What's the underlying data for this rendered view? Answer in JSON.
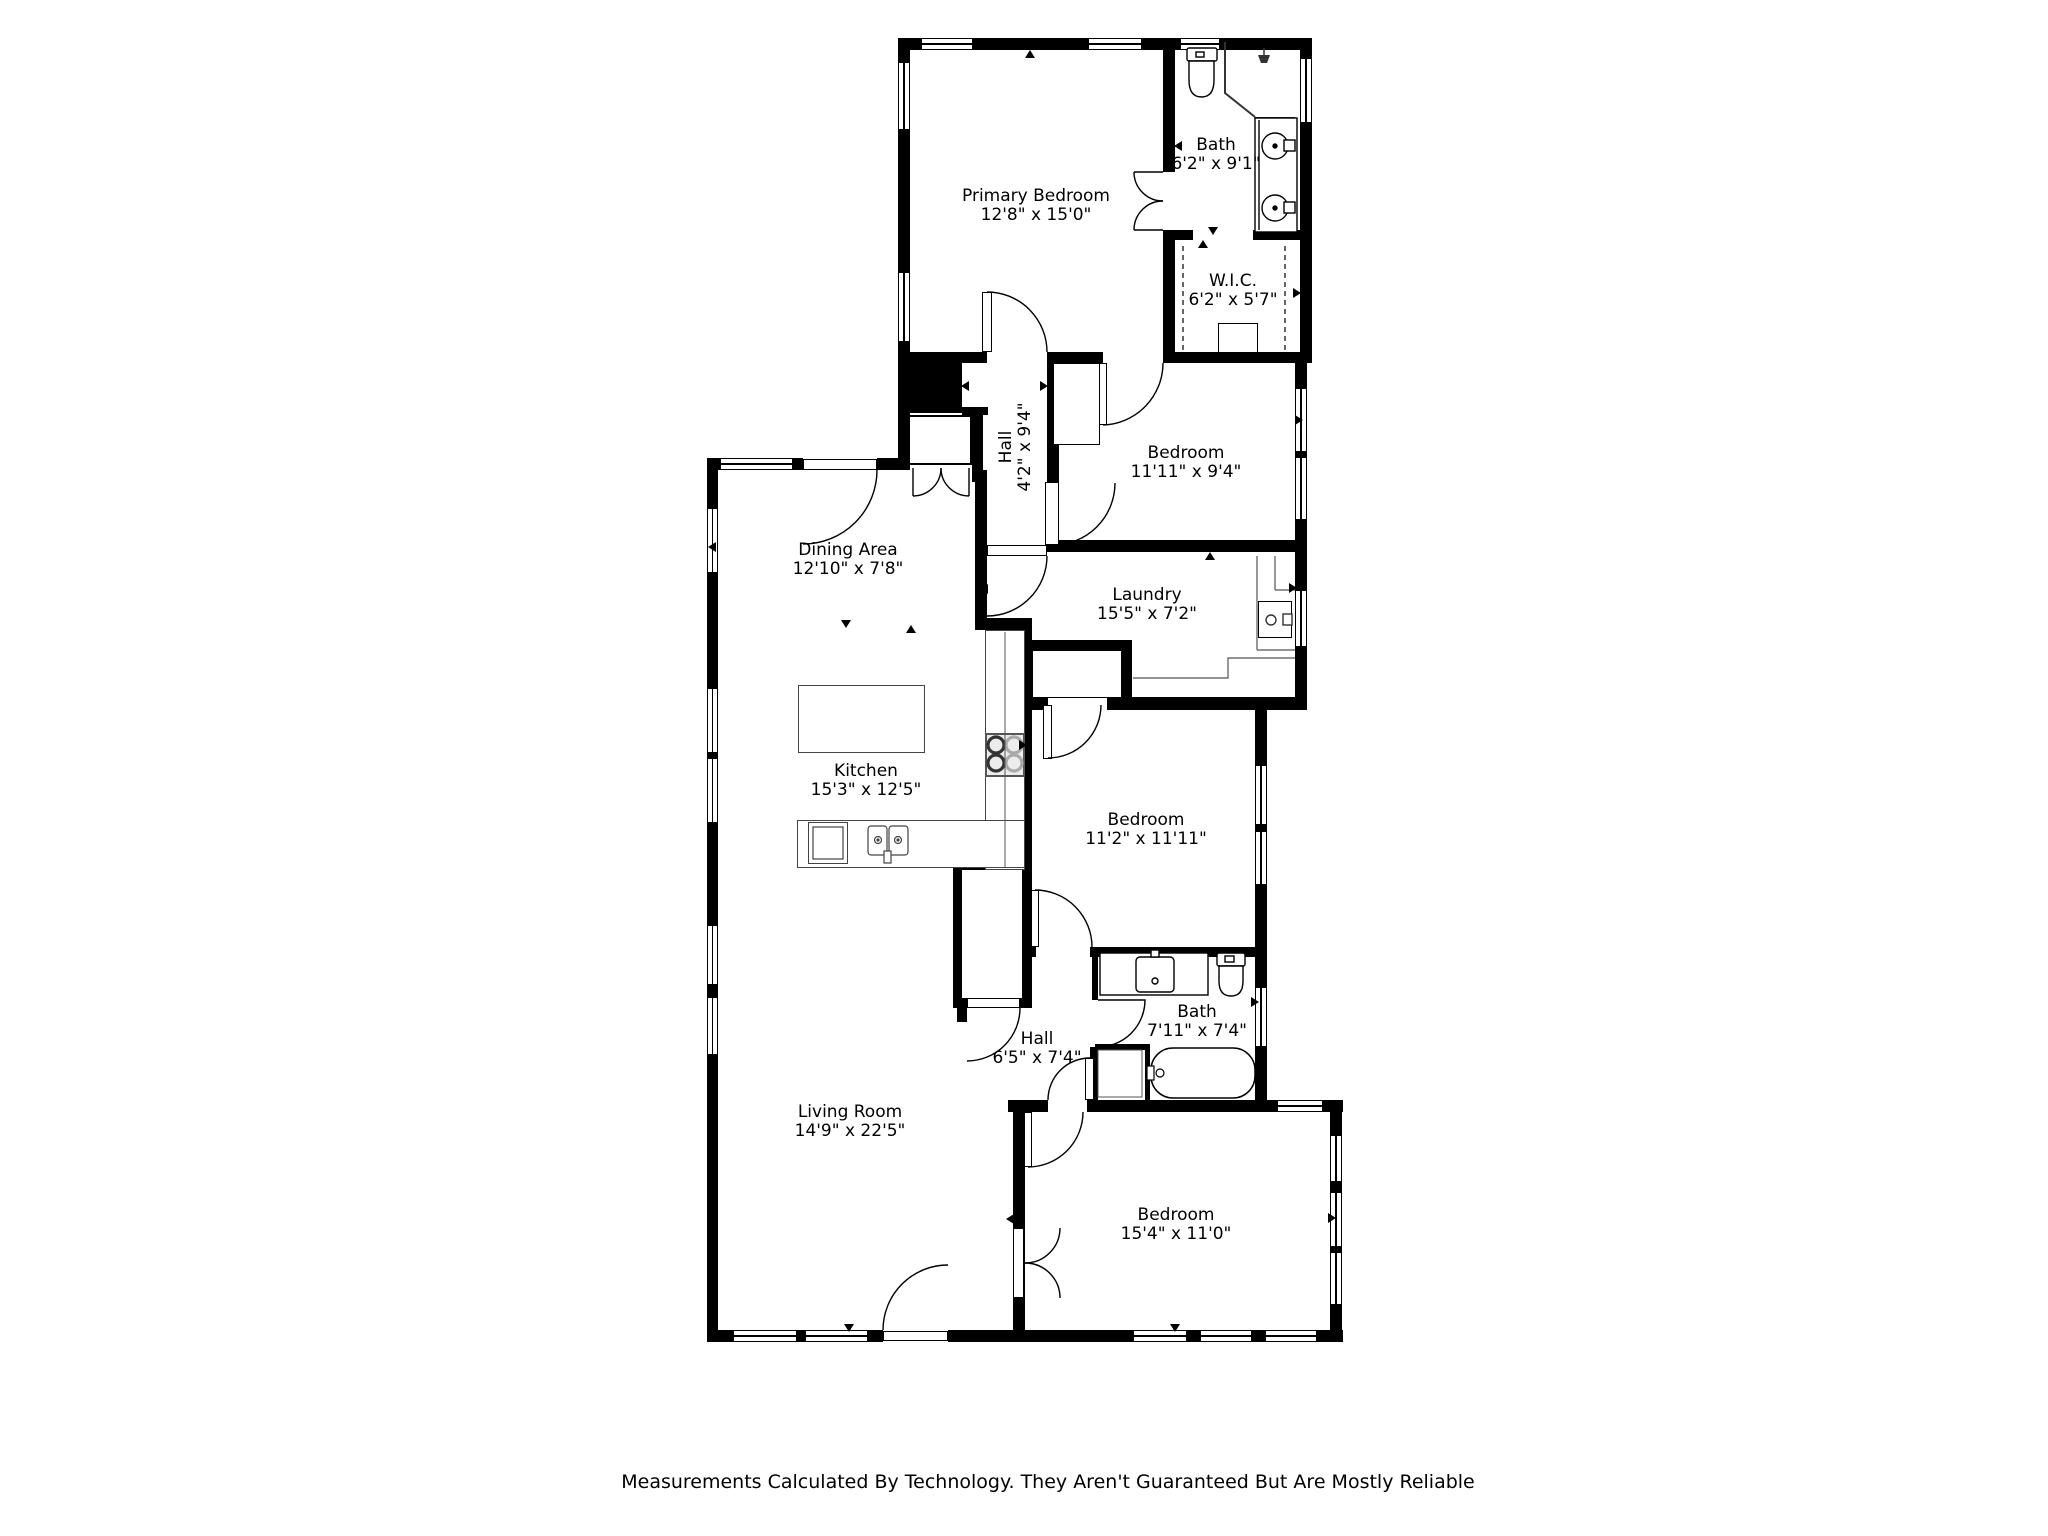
{
  "footer": "Measurements Calculated By Technology. They Aren't Guaranteed But Are Mostly Reliable",
  "colors": {
    "wall": "#000000",
    "background": "#ffffff",
    "counter_line": "#444444"
  },
  "rooms": [
    {
      "name": "Primary Bedroom",
      "dims": "12'8\" x 15'0\""
    },
    {
      "name": "Bath",
      "dims": "6'2\" x 9'1\""
    },
    {
      "name": "W.I.C.",
      "dims": "6'2\" x 5'7\""
    },
    {
      "name": "Hall",
      "dims": "4'2\" x 9'4\""
    },
    {
      "name": "Bedroom",
      "dims": "11'11\" x 9'4\""
    },
    {
      "name": "Dining Area",
      "dims": "12'10\" x 7'8\""
    },
    {
      "name": "Laundry",
      "dims": "15'5\" x 7'2\""
    },
    {
      "name": "Kitchen",
      "dims": "15'3\" x 12'5\""
    },
    {
      "name": "Bedroom",
      "dims": "11'2\" x 11'11\""
    },
    {
      "name": "Bath",
      "dims": "7'11\" x 7'4\""
    },
    {
      "name": "Hall",
      "dims": "6'5\" x 7'4\""
    },
    {
      "name": "Living Room",
      "dims": "14'9\" x 22'5\""
    },
    {
      "name": "Bedroom",
      "dims": "15'4\" x 11'0\""
    }
  ],
  "fixtures": [
    "toilet",
    "shower",
    "double-vanity",
    "walk-in-closet-rods",
    "washer",
    "stove",
    "kitchen-island",
    "kitchen-sink",
    "double-sink",
    "vanity-sink",
    "bathtub"
  ]
}
